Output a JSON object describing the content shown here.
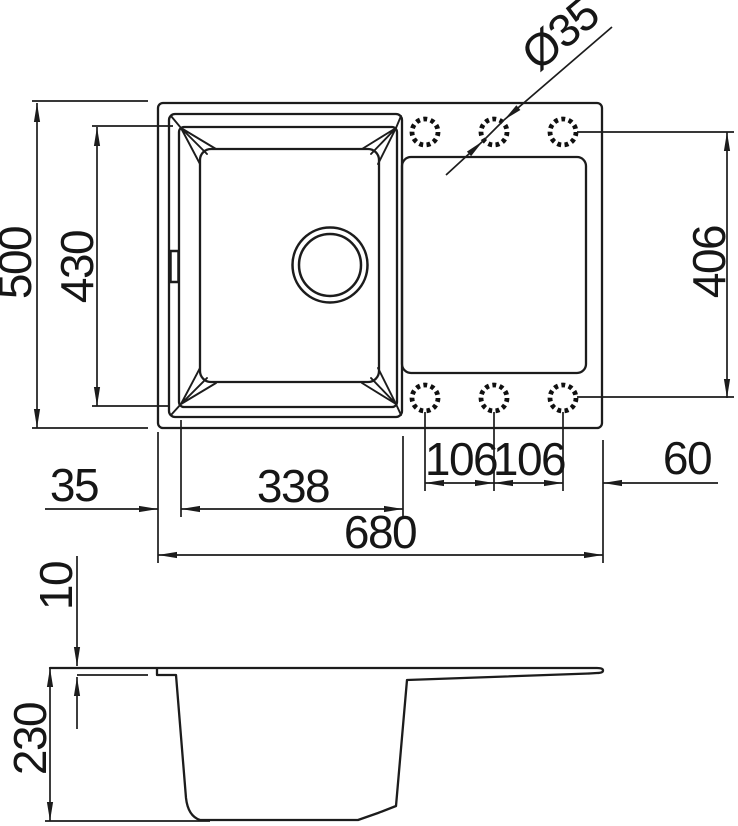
{
  "drawing": {
    "type": "technical-dimension-drawing",
    "subject": "kitchen sink with single bowl and drainboard, top view and side section view",
    "labels": {
      "overall_depth": "500",
      "bowl_depth": "430",
      "holes_span": "406",
      "tap_hole_diameter": "Ø35",
      "edge_offset": "35",
      "bowl_width": "338",
      "overall_width": "680",
      "hole_pitch_left": "106",
      "hole_pitch_right": "106",
      "hole_edge_offset": "60",
      "rim_thickness": "10",
      "body_height": "230"
    },
    "features": {
      "tap_holes_count": "6",
      "drain_hole": "1"
    },
    "colors": {
      "line": "#1c1c1c",
      "text": "#161616",
      "background": "#ffffff"
    }
  }
}
